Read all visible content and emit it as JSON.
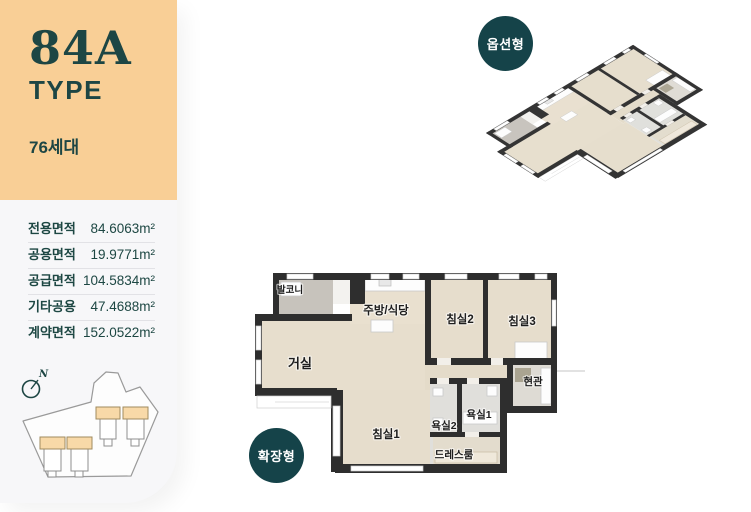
{
  "sidebar": {
    "type_code": "84A",
    "type_label": "TYPE",
    "units": "76세대",
    "areas": [
      {
        "label": "전용면적",
        "value": "84.6063m²"
      },
      {
        "label": "공용면적",
        "value": "19.9771m²"
      },
      {
        "label": "공급면적",
        "value": "104.5834m²"
      },
      {
        "label": "기타공용",
        "value": "47.4688m²"
      },
      {
        "label": "계약면적",
        "value": "152.0522m²"
      }
    ],
    "compass_label": "N"
  },
  "badges": {
    "option": "옵션형",
    "extended": "확장형"
  },
  "floorplan": {
    "rooms": [
      {
        "name": "발코니"
      },
      {
        "name": "주방/식당"
      },
      {
        "name": "침실2"
      },
      {
        "name": "침실3"
      },
      {
        "name": "거실"
      },
      {
        "name": "현관"
      },
      {
        "name": "침실1"
      },
      {
        "name": "욕실2"
      },
      {
        "name": "욕실1"
      },
      {
        "name": "드레스룸"
      }
    ]
  },
  "colors": {
    "header_beige": "#f9cf96",
    "accent_teal": "#1d4644",
    "badge_teal": "#154349",
    "wall_dark": "#2e2e2e",
    "floor_wood": "#e7decd",
    "floor_balcony": "#c7c3bc",
    "site_building_beige": "#f8d9a8"
  }
}
